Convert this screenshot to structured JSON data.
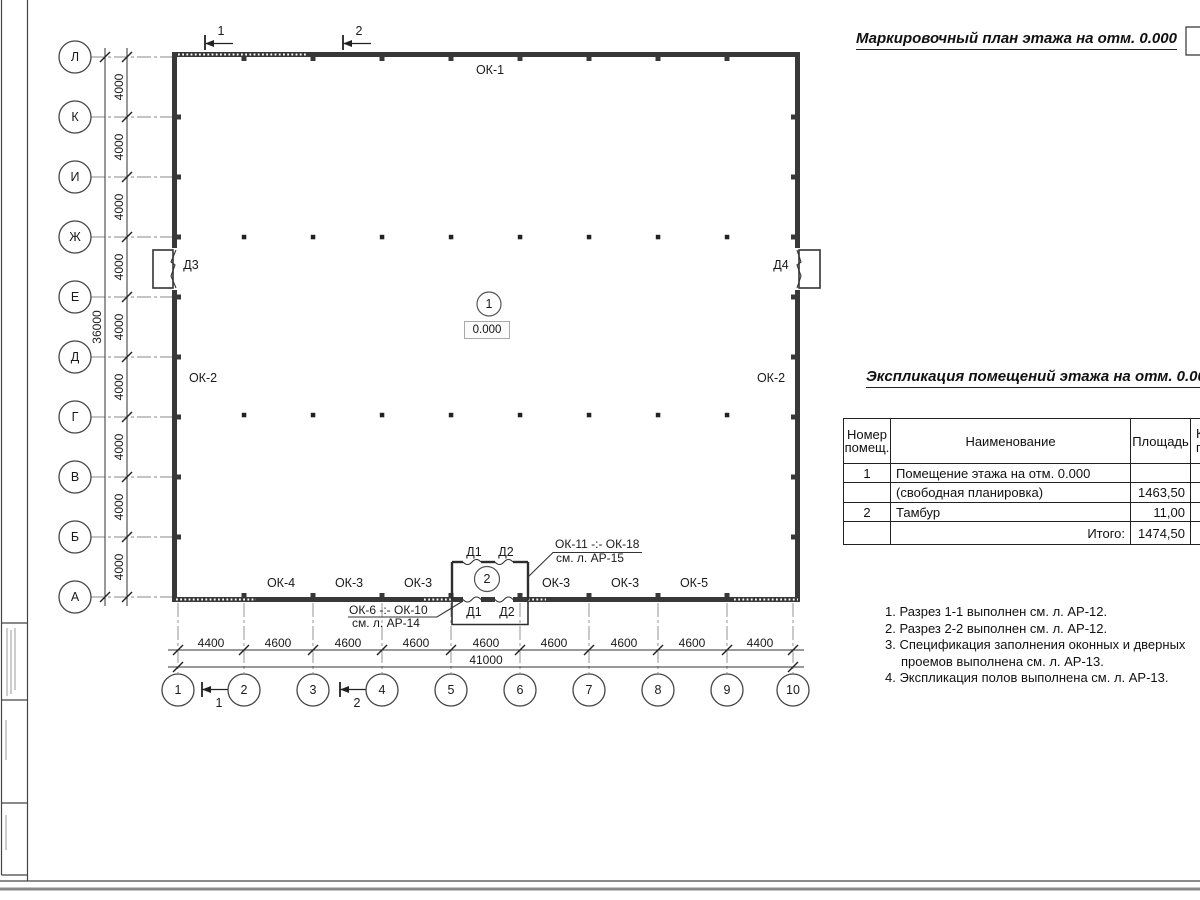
{
  "page": {
    "plan_title": "Маркировочный план этажа на отм. 0.000",
    "table_title": "Экспликация помещений этажа на отм. 0.000"
  },
  "axes": {
    "rows": [
      "Л",
      "К",
      "И",
      "Ж",
      "Е",
      "Д",
      "Г",
      "В",
      "Б",
      "А"
    ],
    "cols": [
      "1",
      "2",
      "3",
      "4",
      "5",
      "6",
      "7",
      "8",
      "9",
      "10"
    ]
  },
  "dims": {
    "v_segments": [
      "4000",
      "4000",
      "4000",
      "4000",
      "4000",
      "4000",
      "4000",
      "4000",
      "4000"
    ],
    "v_total": "36000",
    "h_segments": [
      "4400",
      "4600",
      "4600",
      "4600",
      "4600",
      "4600",
      "4600",
      "4600",
      "4400"
    ],
    "h_total": "41000"
  },
  "sections": {
    "s1": "1",
    "s2": "2"
  },
  "plan": {
    "level_mark": "0.000",
    "room1_num": "1",
    "room2_num": "2",
    "win_top": "ОК-1",
    "win_left": "ОК-2",
    "win_right": "ОК-2",
    "win_bottom": [
      "ОК-4",
      "ОК-3",
      "ОК-3",
      "ОК-3",
      "ОК-3",
      "ОК-5"
    ],
    "door_left": "Д3",
    "door_right": "Д4",
    "door_vest": [
      "Д1",
      "Д2"
    ],
    "callout_right_1": "ОК-11 -:- ОК-18",
    "callout_right_2": "см. л. АР-15",
    "callout_left_1": "ОК-6 -:- ОК-10",
    "callout_left_2": "см. л. АР-14"
  },
  "table": {
    "h_num1": "Номер",
    "h_num2": "помещ.",
    "h_name": "Наименование",
    "h_area": "Площадь",
    "h_cut1": "Ка",
    "h_cut2": "по",
    "rows": [
      {
        "num": "1",
        "name": "Помещение этажа на отм. 0.000",
        "area": ""
      },
      {
        "num": "",
        "name": "(свободная планировка)",
        "area": "1463,50"
      },
      {
        "num": "2",
        "name": "Тамбур",
        "area": "11,00"
      },
      {
        "num": "",
        "name": "Итого:",
        "area": "1474,50"
      }
    ]
  },
  "notes": [
    "1. Разрез 1-1 выполнен см. л. АР-12.",
    "2. Разрез 2-2 выполнен см. л. АР-12.",
    "3. Спецификация заполнения оконных и дверных проемов выполнена см. л. АР-13.",
    "4. Экспликация полов выполнена см. л. АР-13."
  ]
}
